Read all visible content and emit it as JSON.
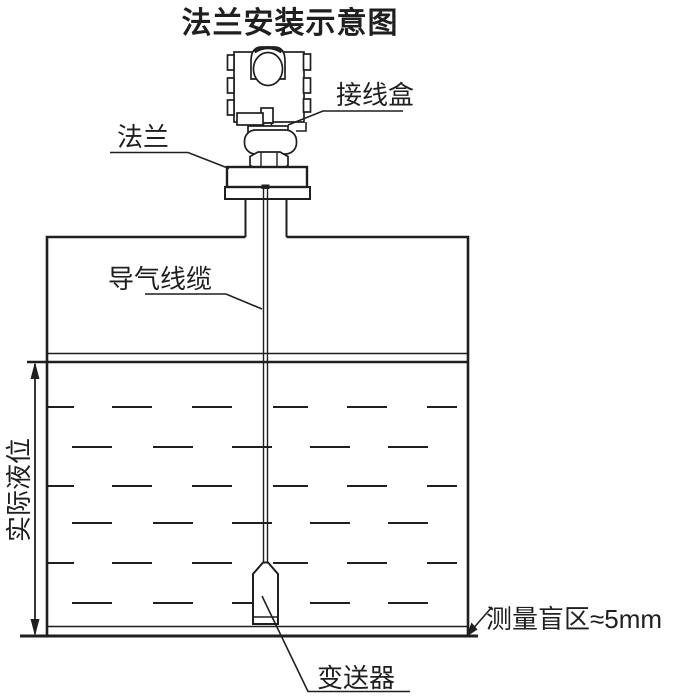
{
  "title": "法兰安装示意图",
  "labels": {
    "junction_box": "接线盒",
    "flange": "法兰",
    "air_cable": "导气线缆",
    "actual_level": "实际液位",
    "transmitter": "变送器",
    "blind_zone": "测量盲区≈5mm"
  },
  "annotations": {
    "blind_zone_value": "≈5mm"
  },
  "colors": {
    "line": "#1f1f1f",
    "background": "#ffffff"
  }
}
